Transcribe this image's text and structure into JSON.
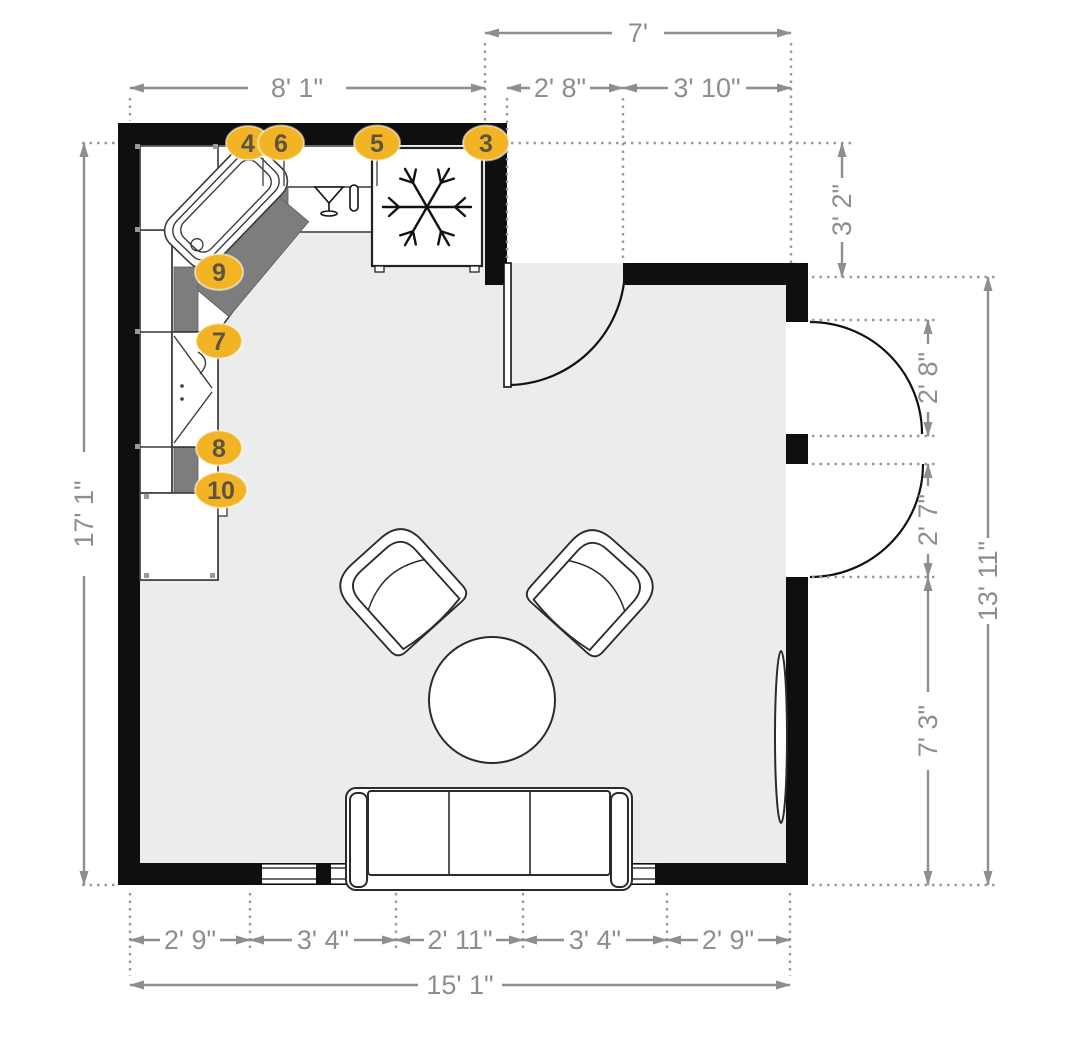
{
  "floor_plan": {
    "markers": {
      "m3": "3",
      "m4": "4",
      "m5": "5",
      "m6": "6",
      "m7": "7",
      "m8": "8",
      "m9": "9",
      "m10": "10"
    },
    "dimensions": {
      "recess_width_total": "7'",
      "top_kitchen_wall": "8' 1\"",
      "entry_door": "2' 8\"",
      "recess_side": "3' 10\"",
      "recess_depth": "3' 2\"",
      "right_door_upper": "2' 8\"",
      "right_door_lower": "2' 7\"",
      "right_total": "13' 11\"",
      "right_lower": "7' 3\"",
      "left_total": "17' 1\"",
      "bottom_seg1": "2' 9\"",
      "bottom_seg2": "3' 4\"",
      "bottom_seg3": "2' 11\"",
      "bottom_seg4": "3' 4\"",
      "bottom_seg5": "2' 9\"",
      "bottom_total": "15' 1\""
    },
    "icons": {
      "fridge": "snowflake-icon",
      "dishwasher": "wine-glass-icon"
    },
    "colors": {
      "marker_fill": "#F2B424",
      "marker_text": "#5E5342",
      "dimension": "#8E8E8E",
      "wall": "#0F0F0F",
      "floor": "#ECECEC",
      "cabinet_filler": "#7D7D7D"
    }
  }
}
